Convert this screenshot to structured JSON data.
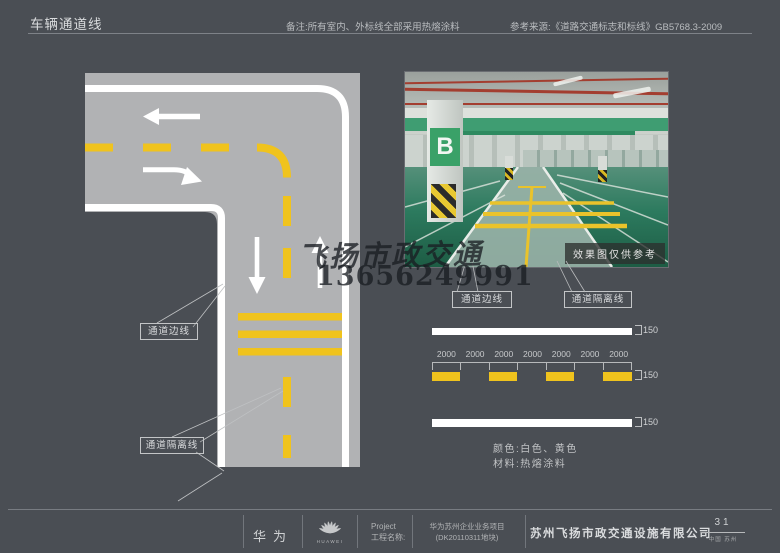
{
  "header": {
    "title": "车辆通道线",
    "note": "备注:所有室内、外标线全部采用热熔涂料",
    "reference": "参考来源:《道路交通标志和标线》GB5768.3-2009"
  },
  "diagram": {
    "callouts": {
      "edge_line": "通道边线",
      "separation_line": "通道隔离线"
    },
    "colors": {
      "background": "#4a4e54",
      "road": "#b1b2b4",
      "marking_white": "#ffffff",
      "marking_yellow": "#f0c31d"
    }
  },
  "photo": {
    "caption": "效果图仅供参考",
    "column_sign": "B",
    "callouts": {
      "edge_line": "通道边线",
      "separation_line": "通道隔离线"
    },
    "colors": {
      "floor_green": "#2c7a5e",
      "lane_green": "#9ab3a8",
      "beam_green": "#3f9d72",
      "pipe_red": "#a33e30"
    }
  },
  "watermark": {
    "line1": "飞扬市政交通",
    "line2": "13656249991"
  },
  "spec": {
    "rows": [
      {
        "type": "solid_white",
        "width_label": "150"
      },
      {
        "type": "dashed_yellow",
        "width_label": "150",
        "segment_labels": [
          "2000",
          "2000",
          "2000",
          "2000",
          "2000",
          "2000",
          "2000"
        ]
      },
      {
        "type": "solid_white",
        "width_label": "150"
      }
    ],
    "color_note": "颜色:白色、黄色",
    "material_note": "材料:热熔涂料"
  },
  "footer": {
    "brand_cn": "华为",
    "brand_en": "HUAWEI",
    "project_label_en": "Project",
    "project_label_cn": "工程名称:",
    "project_line1": "华为苏州企业业务项目",
    "project_line2": "(DK20110311地块)",
    "company": "苏州飞扬市政交通设施有限公司",
    "page_number": "31",
    "location": "中国 苏州"
  }
}
